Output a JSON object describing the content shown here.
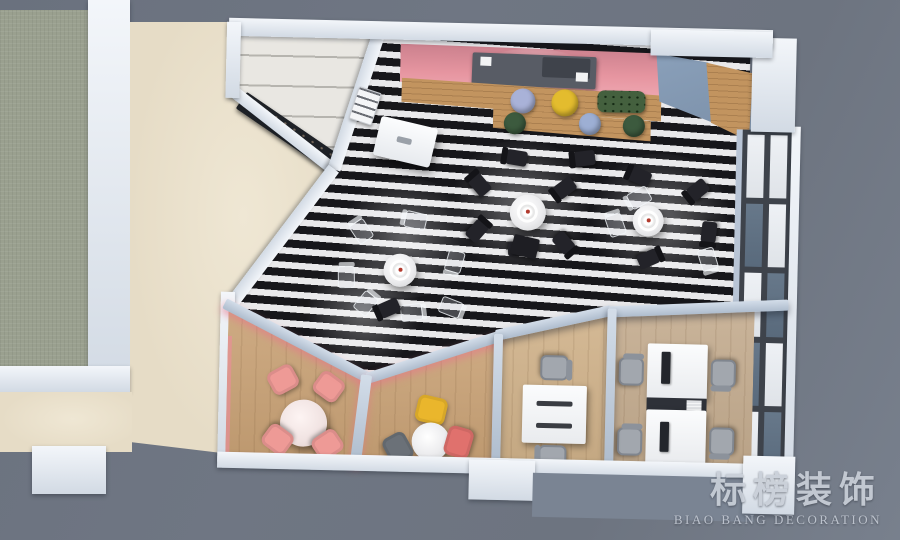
{
  "watermark": {
    "brand_cn": "标榜装饰",
    "brand_en": "BIAO BANG DECORATION"
  },
  "palette": {
    "background": "#6f7683",
    "stripe_dark": "#17171b",
    "stripe_light": "#e9e9eb",
    "green_gray": "#9aa08f",
    "beige_floor": "#e6dcc6",
    "wood_warm": "#c9a276",
    "wood_light": "#d0b28a",
    "wood_gray": "#c4ac8f",
    "wood_bar": "#c2945f",
    "pink_wall": "#e695a0",
    "accent_blue": "#7e93ac",
    "bench_green": "#44603e",
    "chair_dark": "#232329",
    "stool_lavender": "#a9b2d8",
    "stool_yellow": "#e3bc2e",
    "stool_green": "#3c5a3e",
    "stool_blue": "#9dafd4",
    "chair_pink": "#ee9a96",
    "chair_yellow": "#eab62c",
    "chair_red_pink": "#e0716d",
    "chair_gray": "#6b7178",
    "wall_white": "#dde4ec",
    "wall_blue_top": "#b8c4d5",
    "window_frame": "#3e434b",
    "apron_gray": "#7a8493"
  }
}
